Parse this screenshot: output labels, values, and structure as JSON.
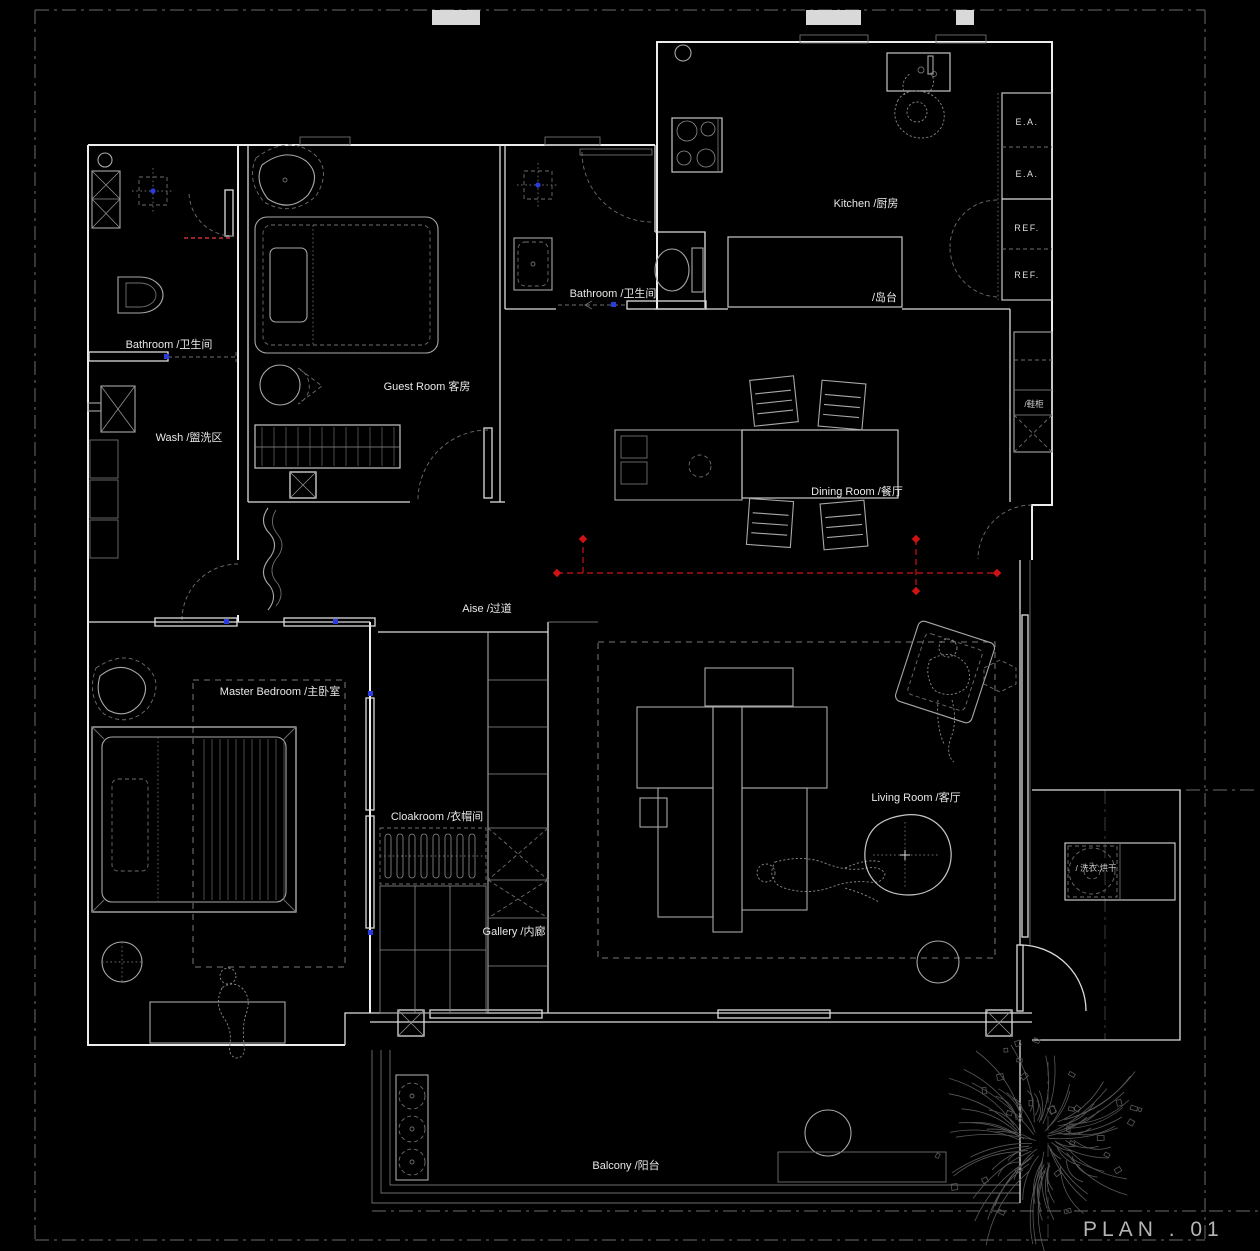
{
  "sheet": {
    "plan_title": "PLAN . 01"
  },
  "labels": {
    "bathroom1": "Bathroom /卫生间",
    "wash": "Wash /盥洗区",
    "guest_room": "Guest Room  客房",
    "bathroom2": "Bathroom /卫生间",
    "kitchen": "Kitchen /厨房",
    "island": "/岛台",
    "dining": "Dining Room /餐厅",
    "shoe_cabinet": "/鞋柜",
    "aisle": "Aise /过道",
    "master_bedroom": "Master Bedroom /主卧室",
    "cloakroom": "Cloakroom /衣帽间",
    "gallery": "Gallery /内廊",
    "living_room": "Living Room  /客厅",
    "laundry": "/ 洗衣.烘干",
    "balcony": "Balcony /阳台"
  },
  "cabinets": {
    "ea_top": "E.A.",
    "ea_bottom": "E.A.",
    "ref_top": "REF.",
    "ref_bottom": "REF."
  },
  "colors": {
    "background": "#000000",
    "wall": "#ededed",
    "furniture": "#a8a8a8",
    "axis_red": "#cf1212",
    "marker_blue": "#2b3bde",
    "sheet_border": "#6b6b6b",
    "label_text": "#e8e8e8",
    "title_text": "#b5b5b5"
  }
}
